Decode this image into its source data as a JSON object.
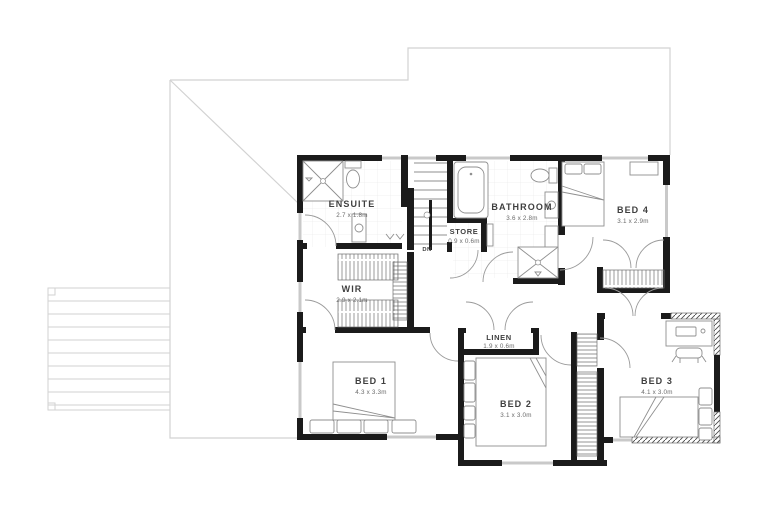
{
  "plan": {
    "type": "floor-plan",
    "floor": "upper-floor",
    "rooms": [
      {
        "name": "ENSUITE",
        "dims": "2.7 x 1.8m"
      },
      {
        "name": "STORE",
        "dims": "0.9 x 0.6m"
      },
      {
        "name": "BATHROOM",
        "dims": "3.6 x 2.8m"
      },
      {
        "name": "BED 4",
        "dims": "3.1 x 2.9m"
      },
      {
        "name": "WIR",
        "dims": "2.9 x 2.1m"
      },
      {
        "name": "LINEN",
        "dims": "1.9 x 0.6m"
      },
      {
        "name": "BED 1",
        "dims": "4.3 x 3.3m"
      },
      {
        "name": "BED 2",
        "dims": "3.1 x 3.0m"
      },
      {
        "name": "BED 3",
        "dims": "4.1 x 3.0m"
      }
    ],
    "annotations": {
      "stairs_direction": "DN"
    },
    "colors": {
      "wall": "#1b1b1b",
      "thin": "#8f8f8f",
      "roof": "#d2d2d2",
      "glass": "#c9c9c9",
      "ink": "#3f3f3f",
      "ink2": "#6a6a6a"
    }
  }
}
